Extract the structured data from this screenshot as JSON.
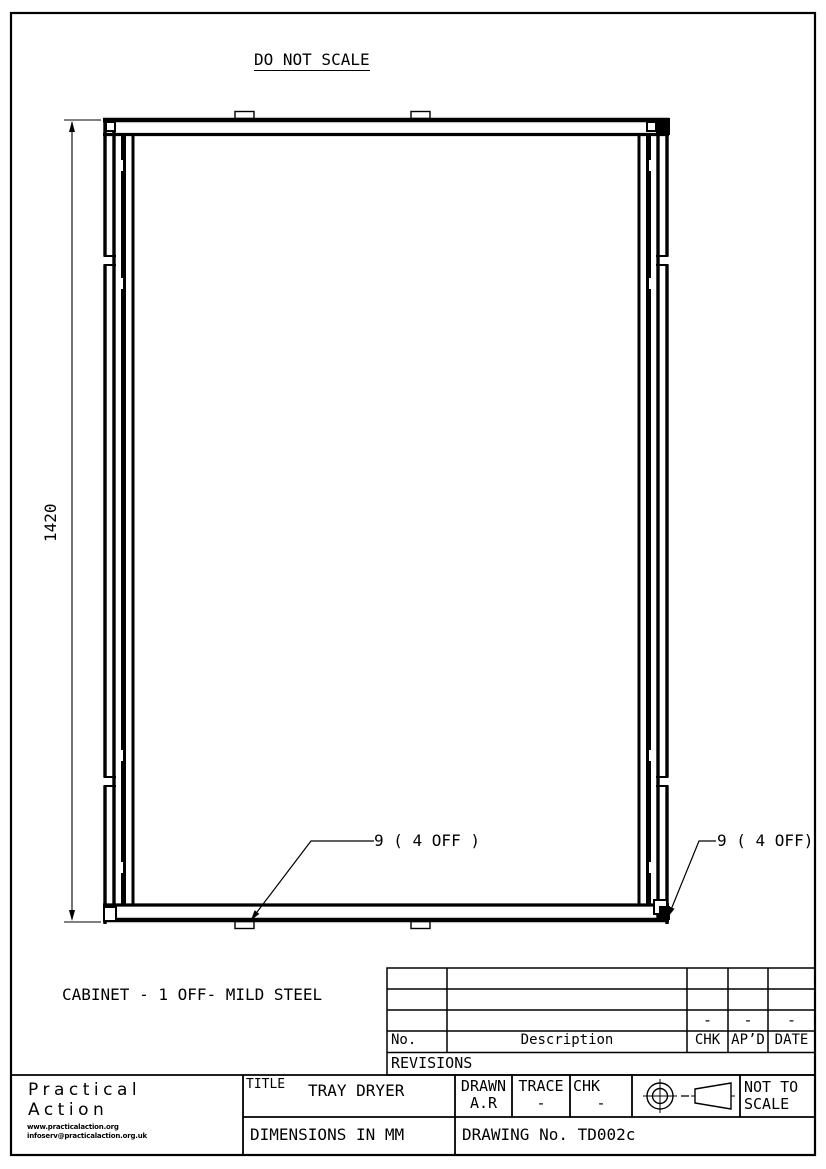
{
  "page": {
    "do_not_scale": "DO NOT SCALE",
    "caption": "CABINET - 1 OFF- MILD STEEL"
  },
  "drawing": {
    "dimension_height": "1420",
    "callout_left": "9 ( 4 OFF )",
    "callout_right": "9 ( 4 OFF)"
  },
  "revisions": {
    "label": "REVISIONS",
    "headers": {
      "no": "No.",
      "description": "Description",
      "chk": "CHK",
      "apd": "AP’D",
      "date": "DATE"
    },
    "row3": {
      "chk": "-",
      "apd": "-",
      "date": "-"
    }
  },
  "title_block": {
    "org_line1": "Practical",
    "org_line2": "Action",
    "org_url": "www.practicalaction.org",
    "org_email": "infoserv@practicalaction.org.uk",
    "title_label": "TITLE",
    "title_value": "TRAY DRYER",
    "drawn_label": "DRAWN",
    "drawn_value": "A.R",
    "trace_label": "TRACE",
    "trace_value": "-",
    "chk_label": "CHK",
    "chk_value": "-",
    "scale_note_line1": "NOT TO",
    "scale_note_line2": "SCALE",
    "dimensions_note": "DIMENSIONS IN MM",
    "drawing_no": "DRAWING No. TD002c"
  }
}
